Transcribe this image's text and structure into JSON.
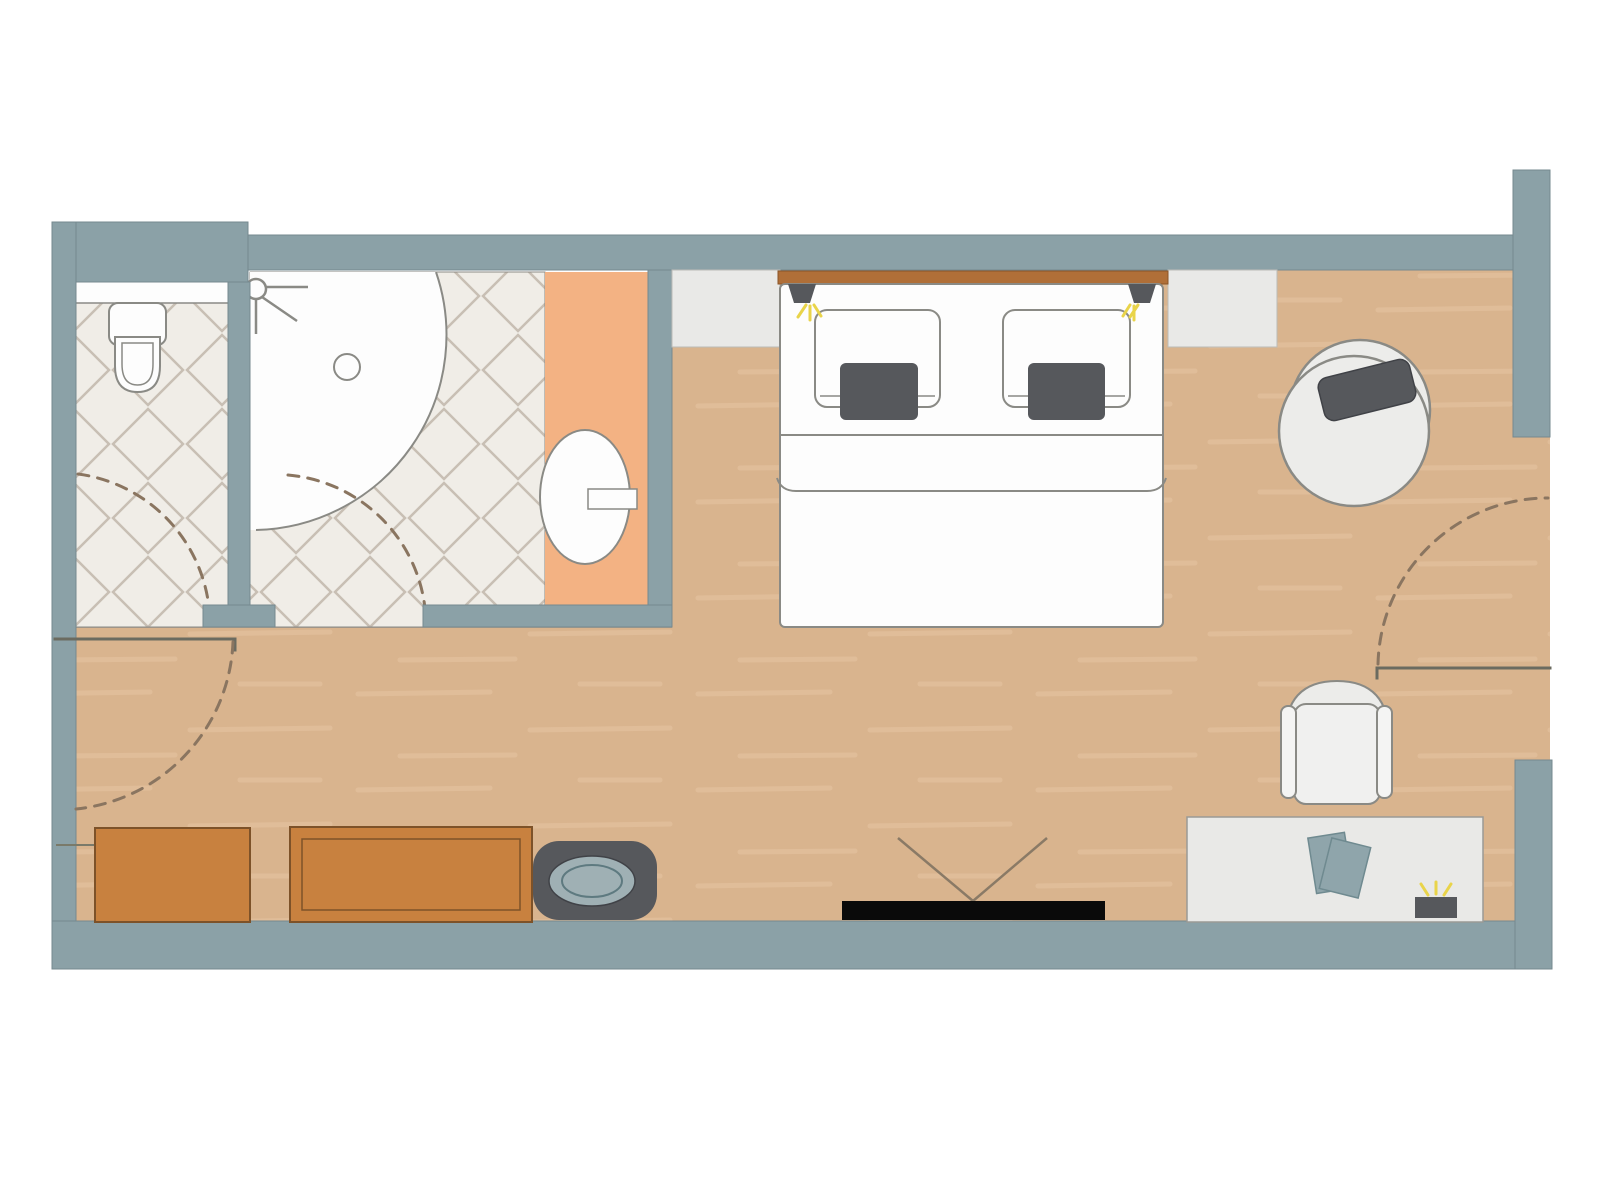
{
  "scene": {
    "kind": "hotel-guest-room-floor-plan",
    "orientation": "top-down",
    "visible_text": []
  },
  "colors": {
    "page-bg": "#ffffff",
    "wall": "#8ba1a7",
    "wall-edge": "#76898f",
    "floor": "#d9b48e",
    "floor-streak": "#e6c4a2",
    "tile-bg": "#f0ede7",
    "tile-line": "#c8bfb4",
    "white": "#fdfdfd",
    "outline": "#8a8a85",
    "orange": "#f3b283",
    "ledge": "#e9e9e7",
    "ledge-edge": "#bcbcb7",
    "dark": "#56585c",
    "dark-edge": "#404247",
    "wood": "#c8813f",
    "wood-edge": "#7d5229",
    "headboard": "#b06f38",
    "headboard-edge": "#8a5427",
    "paper": "#8fa5ab",
    "paper-edge": "#6f8a90",
    "stool-oval": "#9fb0b4",
    "stool-oval-ring": "#5e7a80",
    "lamp-yellow": "#e9d44a",
    "dash": "#8a7560",
    "leaf": "#6b6b60",
    "tv": "#0a0a0a",
    "vline": "#8a7a66"
  },
  "rooms": [
    {
      "name": "wc-room",
      "floor": "diagonal-tile"
    },
    {
      "name": "shower-room",
      "floor": "diagonal-tile"
    },
    {
      "name": "bedroom",
      "floor": "wood"
    },
    {
      "name": "entry-vestibule",
      "floor": "wood"
    }
  ],
  "furniture": [
    {
      "name": "toilet"
    },
    {
      "name": "shower-quarter-circle"
    },
    {
      "name": "shower-head-symbol"
    },
    {
      "name": "shower-drain"
    },
    {
      "name": "vanity-counter-orange"
    },
    {
      "name": "oval-sink-with-faucet"
    },
    {
      "name": "double-bed"
    },
    {
      "name": "headboard"
    },
    {
      "name": "reading-lamp-left"
    },
    {
      "name": "reading-lamp-right"
    },
    {
      "name": "pillow-left"
    },
    {
      "name": "pillow-right"
    },
    {
      "name": "cushion-left"
    },
    {
      "name": "cushion-right"
    },
    {
      "name": "bedside-ledge-left"
    },
    {
      "name": "bedside-ledge-right"
    },
    {
      "name": "round-lounge-chair-with-cushion"
    },
    {
      "name": "armchair"
    },
    {
      "name": "desk"
    },
    {
      "name": "papers-on-desk"
    },
    {
      "name": "desk-lamp"
    },
    {
      "name": "dresser-plain"
    },
    {
      "name": "dresser-framed"
    },
    {
      "name": "stool-dark-oval-top"
    },
    {
      "name": "wall-tv"
    },
    {
      "name": "tv-viewing-angle"
    },
    {
      "name": "door-swing-arc-wc-inside"
    },
    {
      "name": "door-swing-arc-wc-outside"
    },
    {
      "name": "door-swing-arc-shower"
    },
    {
      "name": "entry-door-leaf"
    },
    {
      "name": "entry-door-swing-arc"
    }
  ]
}
